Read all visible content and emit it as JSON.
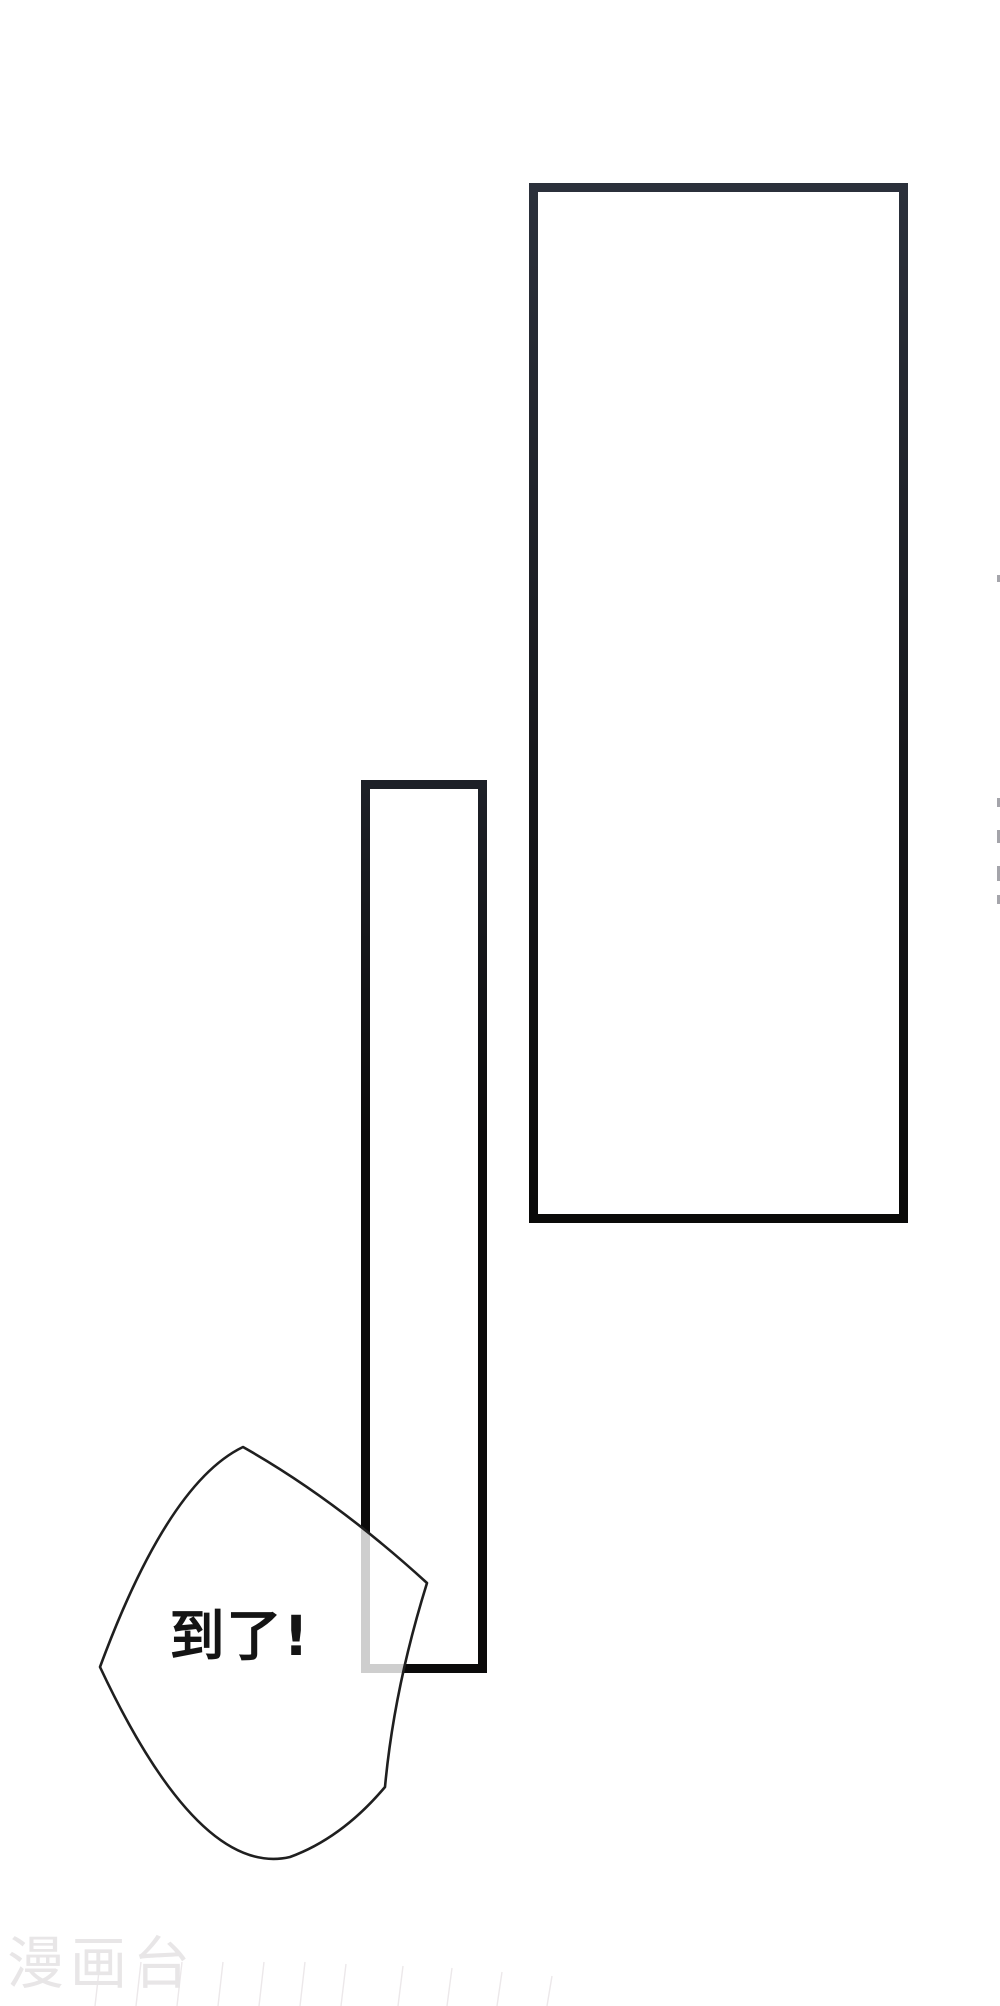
{
  "speech_bubble": {
    "text": "到了!"
  },
  "watermark": {
    "text": "漫画台"
  },
  "colors": {
    "paper": "#ffffff",
    "large_panel_ink_top": "#2b303b",
    "large_panel_ink_mid": "#17181c",
    "large_panel_ink_bottom": "#0a0a09",
    "tall_panel_ink_top": "#1d2027",
    "tall_panel_ink_bottom": "#0b0a0a",
    "bubble_outline": "#1f1f1f",
    "bubble_fill": "#ffffff",
    "dialogue_ink": "#141414",
    "watermark_gray": "#e8e6e7",
    "edge_fragment_gray": "#8e8e96",
    "crease_line": "#ece8ea"
  }
}
